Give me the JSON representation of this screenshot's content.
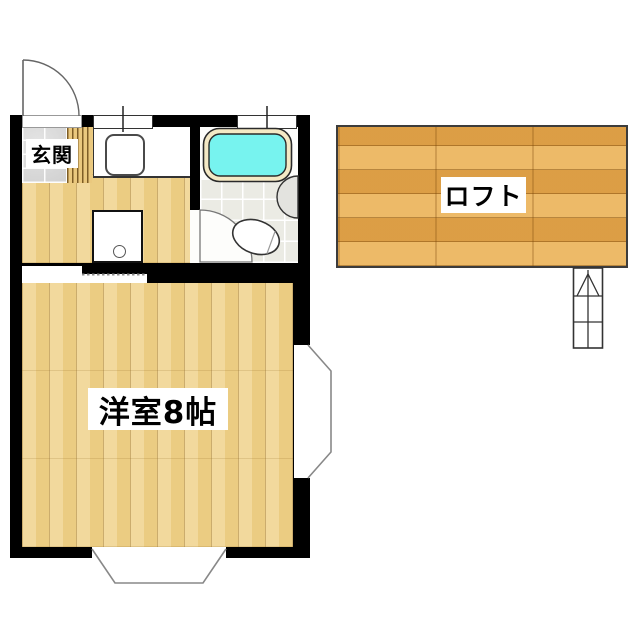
{
  "floorplan": {
    "labels": {
      "entrance": "玄関",
      "main_room": "洋室8帖",
      "loft": "ロフト"
    },
    "colors": {
      "wall": "#000000",
      "wood_floor": "#efd28a",
      "loft_wood": "#e7a94e",
      "entrance_tile": "#d5d5d5",
      "bath_tile": "#ebebe4",
      "bathtub_water": "#77f3ef",
      "bathtub_rim": "#f4e9c5",
      "fixture_white": "#ffffff"
    },
    "fixtures": [
      "entrance-door",
      "entrance-step",
      "kitchen-counter",
      "kitchen-sink",
      "kitchen-window",
      "washing-machine-space",
      "sliding-door",
      "bathroom-door",
      "bathtub",
      "bathroom-window",
      "washbasin",
      "toilet",
      "side-bay-window",
      "bottom-bay-window",
      "loft-ladder"
    ]
  }
}
